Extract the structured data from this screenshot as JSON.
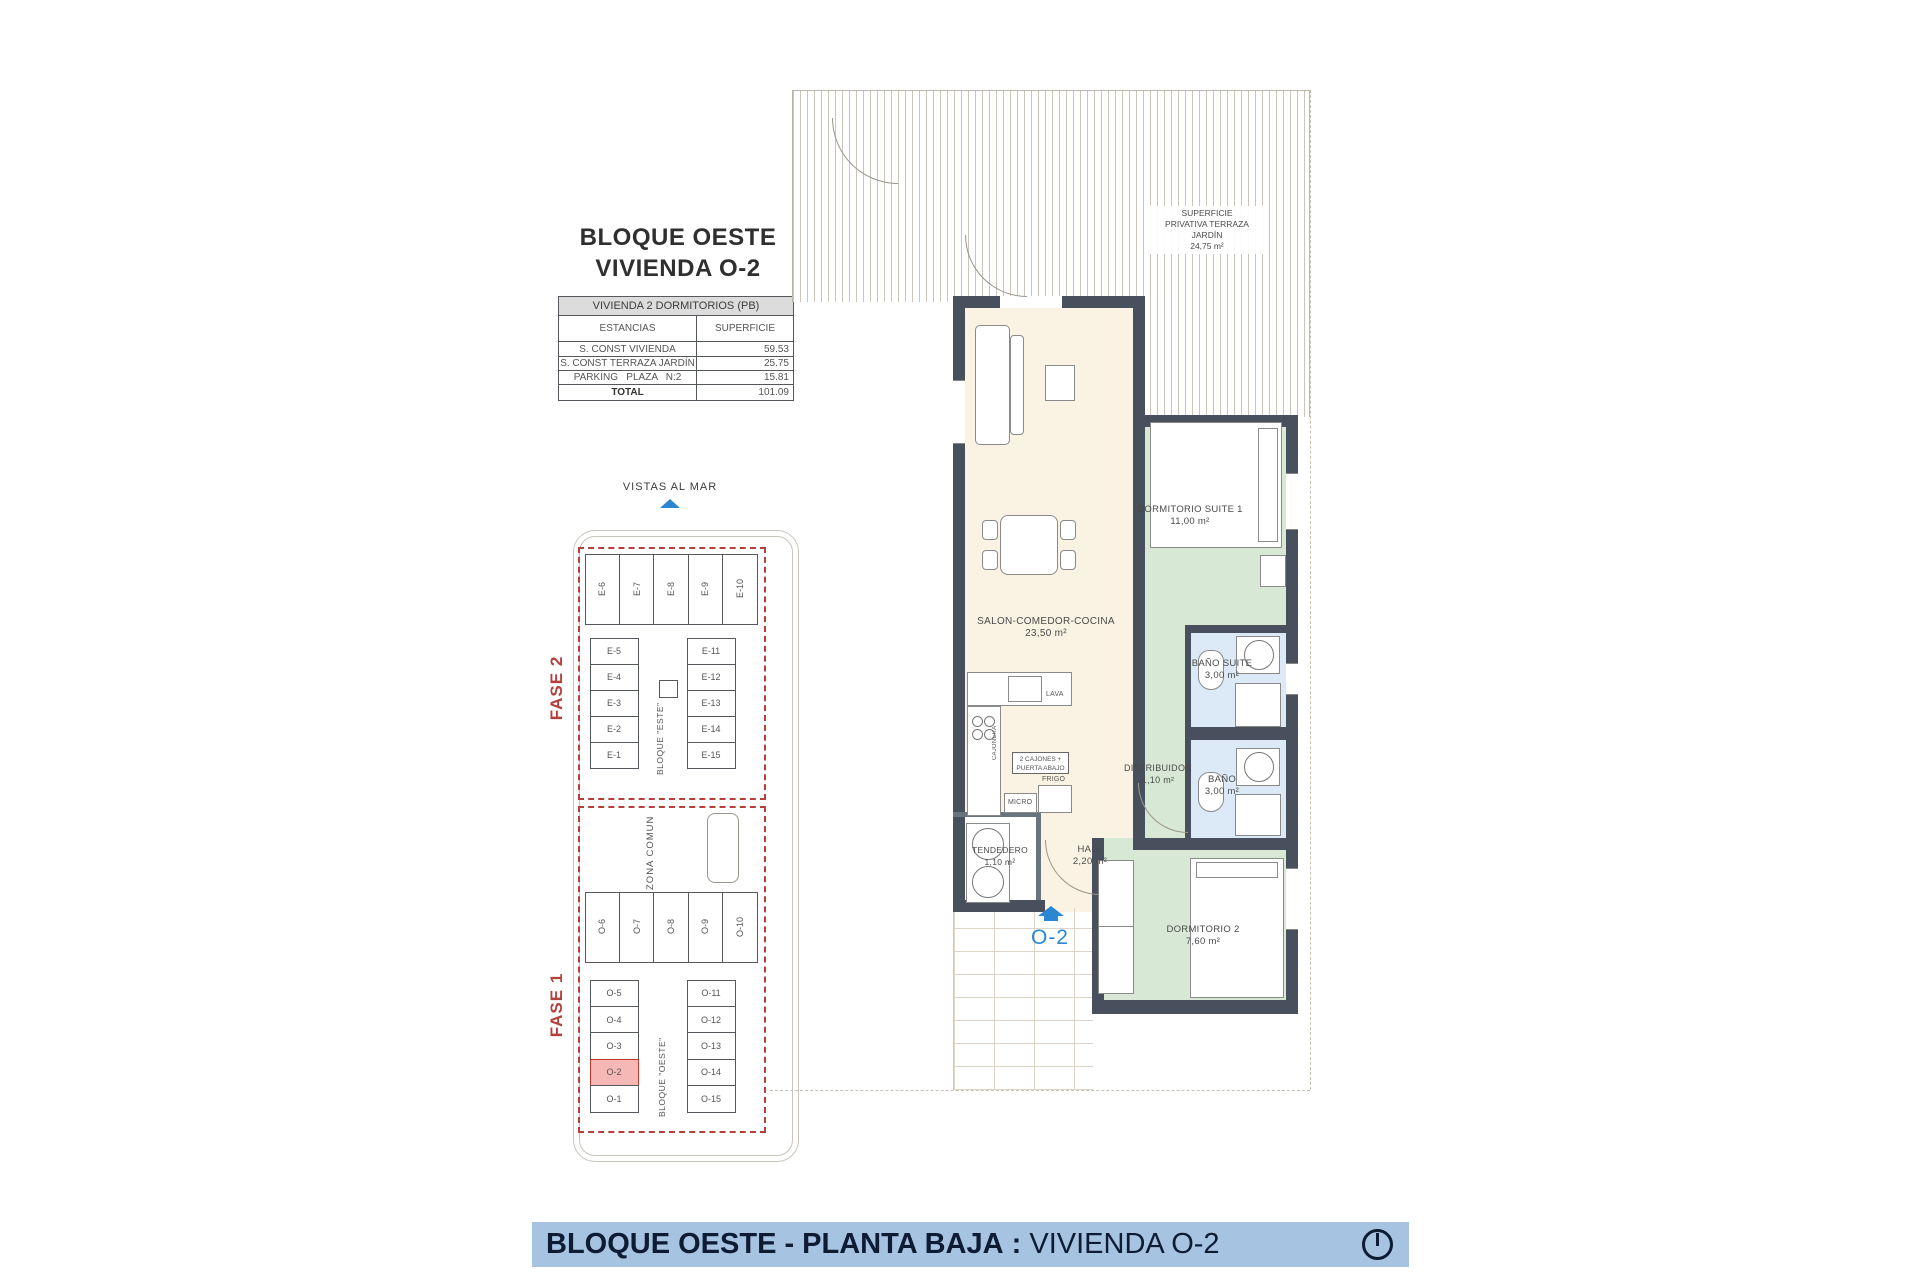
{
  "header": {
    "title_line1": "BLOQUE OESTE",
    "title_line2": "VIVIENDA O-2"
  },
  "summary_table": {
    "title": "VIVIENDA 2 DORMITORIOS (PB)",
    "columns": {
      "estancias": "ESTANCIAS",
      "superficie": "SUPERFICIE"
    },
    "rows": [
      {
        "label": "S. CONST VIVIENDA",
        "value": "59.53"
      },
      {
        "label": "S. CONST TERRAZA JARDÍN",
        "value": "25.75"
      },
      {
        "label": "PARKING   PLAZA   N:2",
        "value": "15.81"
      }
    ],
    "total": {
      "label": "TOTAL",
      "value": "101.09"
    }
  },
  "siteplan": {
    "vistas_al_mar": "VISTAS AL MAR",
    "fase2": "FASE 2",
    "fase1": "FASE 1",
    "zona_comun": "ZONA COMUN",
    "bloque_este": "BLOQUE \"ESTE\"",
    "bloque_oeste": "BLOQUE \"OESTE\"",
    "este_top": [
      "E-6",
      "E-7",
      "E-8",
      "E-9",
      "E-10"
    ],
    "este_left": [
      "E-5",
      "E-4",
      "E-3",
      "E-2",
      "E-1"
    ],
    "este_right": [
      "E-11",
      "E-12",
      "E-13",
      "E-14",
      "E-15"
    ],
    "oeste_top": [
      "O-6",
      "O-7",
      "O-8",
      "O-9",
      "O-10"
    ],
    "oeste_left": [
      "O-5",
      "O-4",
      "O-3",
      "O-2",
      "O-1"
    ],
    "oeste_right": [
      "O-11",
      "O-12",
      "O-13",
      "O-14",
      "O-15"
    ],
    "highlighted_unit": "O-2"
  },
  "floorplan": {
    "terrace": {
      "line1": "SUPERFICIE",
      "line2": "PRIVATIVA TERRAZA",
      "line3": "JARDÍN",
      "line4": "24,75 m²"
    },
    "rooms": {
      "salon": {
        "name": "SALON-COMEDOR-COCINA",
        "area": "23,50 m²"
      },
      "suite": {
        "name": "DORMITORIO SUITE 1",
        "area": "11,00 m²"
      },
      "bano_suite": {
        "name": "BAÑO SUITE",
        "area": "3,00 m²"
      },
      "bano": {
        "name": "BAÑO",
        "area": "3,00 m²"
      },
      "distribuidor": {
        "name": "DISTRIBUIDOR",
        "area": "1,10 m²"
      },
      "hall": {
        "name": "HALL",
        "area": "2,20 m²"
      },
      "tendedero": {
        "name": "TENDEDERO",
        "area": "1,10 m²"
      },
      "dormitorio2": {
        "name": "DORMITORIO 2",
        "area": "7,60 m²"
      }
    },
    "kitchen": {
      "lava": "LAVA",
      "cajonera": "CAJONERA",
      "cajones": "2 CAJONES + PUERTA ABAJO",
      "frigo": "FRIGO",
      "micro": "MICRO"
    },
    "unit_tag": "O-2"
  },
  "footer": {
    "title_bold": "BLOQUE OESTE - PLANTA BAJA",
    "separator": ":",
    "title_light": "VIVIENDA O-2"
  },
  "colors": {
    "accent_red": "#b4403c",
    "accent_blue": "#2b87d1",
    "wall": "#47505c",
    "banner_bg": "#a6c3e2",
    "banner_text": "#0d1b33",
    "highlight_fill": "#f5b8b5",
    "room_cream": "#faf3e3",
    "room_green": "#d7e8d5",
    "room_blue": "#dce9f6"
  }
}
